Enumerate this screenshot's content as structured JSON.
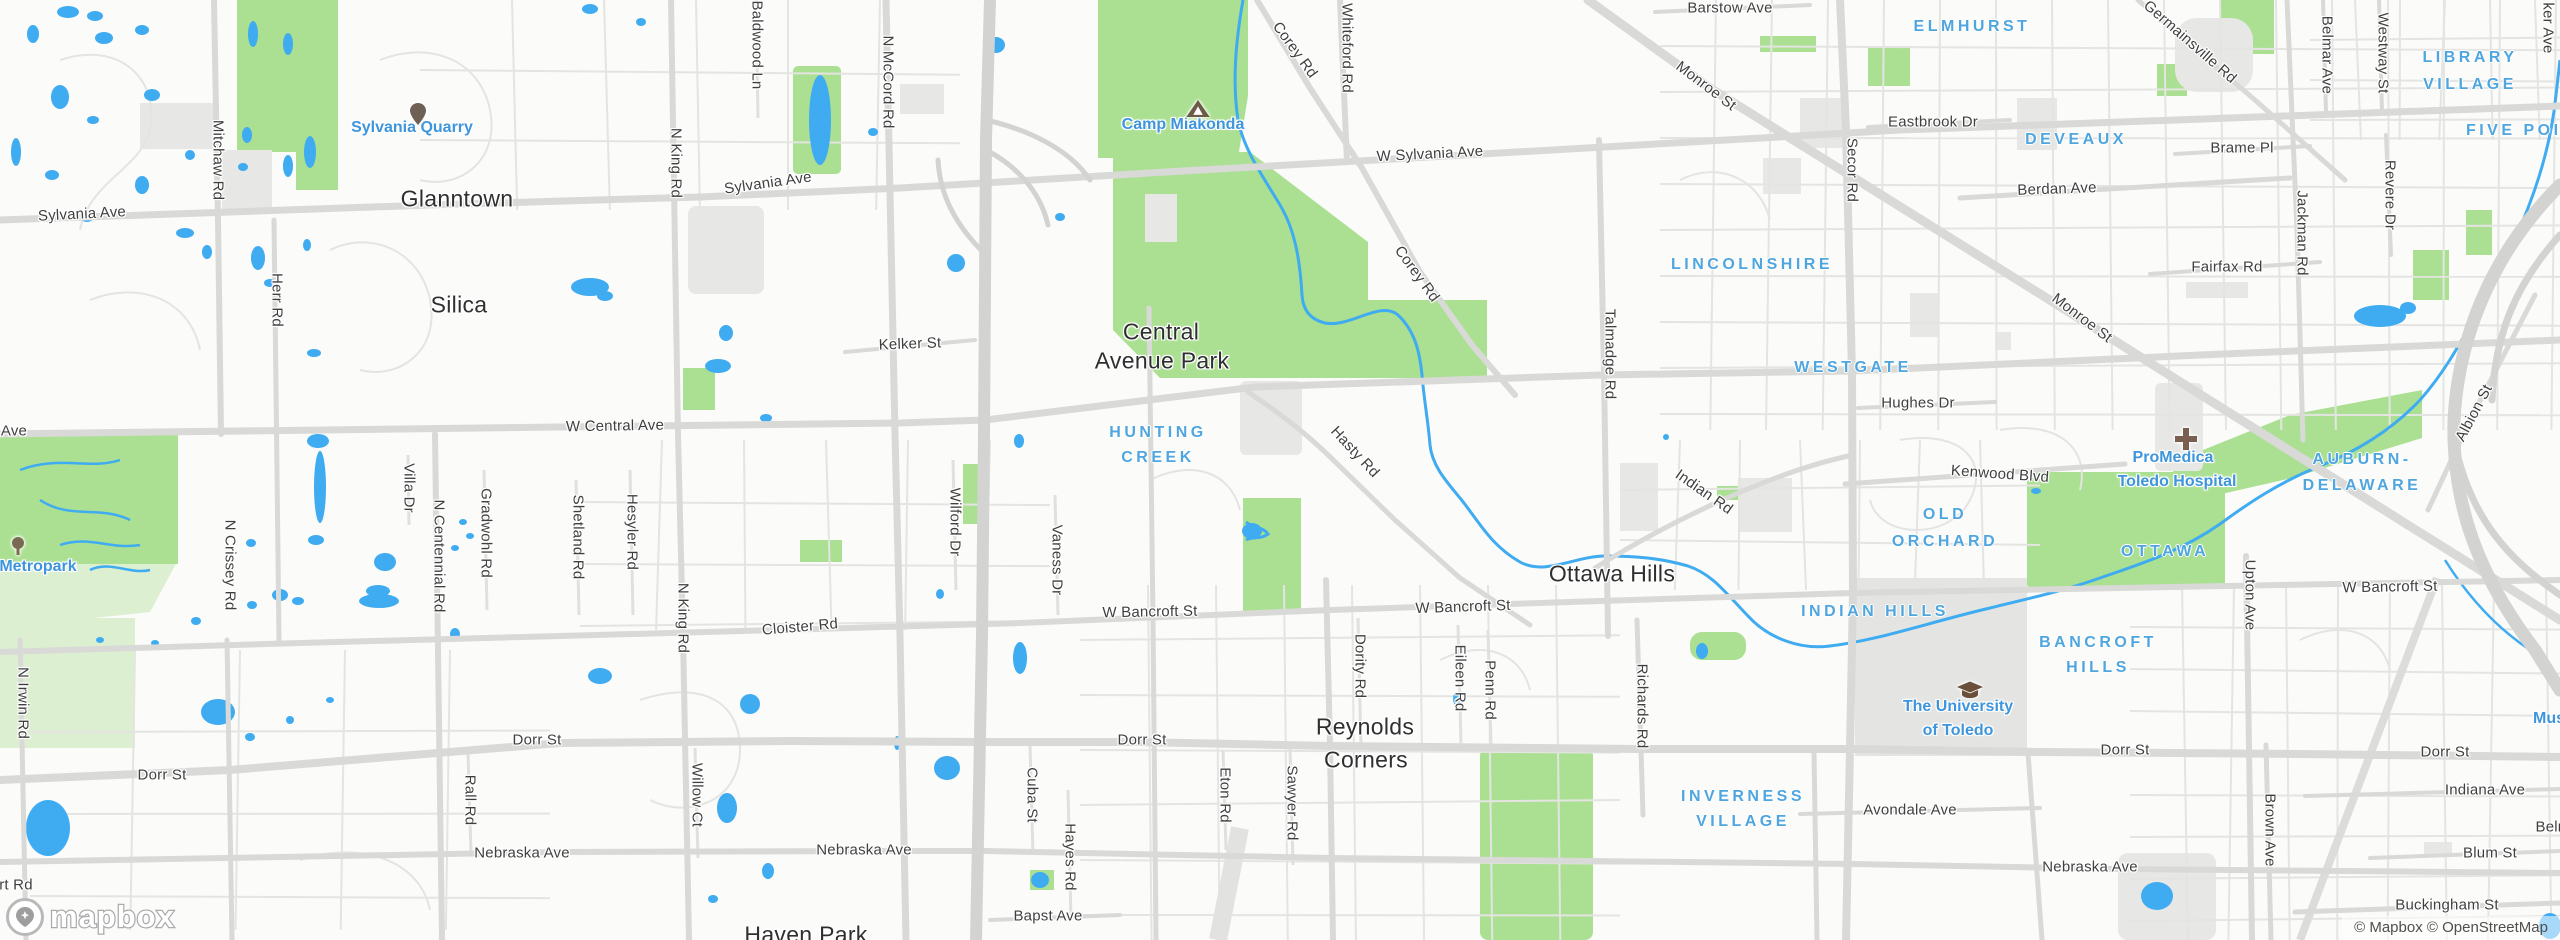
{
  "map": {
    "attribution": "© Mapbox © OpenStreetMap",
    "logo_text": "mapbox",
    "palette": {
      "land": "#FBFBF9",
      "park_green": "#ABE092",
      "pale_green": "#DCEFD0",
      "water_blue": "#3FABF1",
      "urban_gray": "#E7E7E5",
      "road_major": "#D9D9D7",
      "road_minor": "#E4E4E2",
      "highway": "#D3D3D1",
      "label_dark": "#2f2f2f",
      "label_road": "#3f3f3f",
      "label_neighborhood_blue": "#4FA6DF",
      "label_poi_blue": "#3E95DC",
      "icon_brown": "#6e6055"
    },
    "labels": [
      {
        "t": "Sylvania Ave",
        "x": 82,
        "y": 214,
        "r": -3,
        "c": "road"
      },
      {
        "t": "Mitchaw Rd",
        "x": 218,
        "y": 160,
        "r": 90,
        "c": "road"
      },
      {
        "t": "Herr Rd",
        "x": 277,
        "y": 300,
        "r": 90,
        "c": "road"
      },
      {
        "t": "Glanntown",
        "x": 457,
        "y": 199,
        "r": 0,
        "c": "city"
      },
      {
        "t": "Silica",
        "x": 459,
        "y": 305,
        "r": 0,
        "c": "city"
      },
      {
        "t": "Sylvania Quarry",
        "x": 412,
        "y": 128,
        "r": 0,
        "c": "poi"
      },
      {
        "t": "Sylvania Ave",
        "x": 768,
        "y": 183,
        "r": -8,
        "c": "road"
      },
      {
        "t": "N King Rd",
        "x": 676,
        "y": 163,
        "r": 90,
        "c": "road"
      },
      {
        "t": "Baldwood Ln",
        "x": 757,
        "y": 45,
        "r": 90,
        "c": "road"
      },
      {
        "t": "N McCord Rd",
        "x": 888,
        "y": 82,
        "r": 90,
        "c": "road"
      },
      {
        "t": "Kelker St",
        "x": 910,
        "y": 344,
        "r": -2,
        "c": "road"
      },
      {
        "t": "W Central Ave",
        "x": 615,
        "y": 426,
        "r": -1,
        "c": "road"
      },
      {
        "t": "Ave",
        "x": 14,
        "y": 431,
        "r": 0,
        "c": "road"
      },
      {
        "t": "Camp Miakonda",
        "x": 1183,
        "y": 125,
        "r": 0,
        "c": "poi"
      },
      {
        "t": "Corey Rd",
        "x": 1295,
        "y": 50,
        "r": 54,
        "c": "road"
      },
      {
        "t": "Whiteford Rd",
        "x": 1347,
        "y": 48,
        "r": 90,
        "c": "road"
      },
      {
        "t": "W Sylvania Ave",
        "x": 1430,
        "y": 154,
        "r": -3,
        "c": "road"
      },
      {
        "t": "Corey Rd",
        "x": 1417,
        "y": 274,
        "r": 54,
        "c": "road"
      },
      {
        "t": "Monroe St",
        "x": 1706,
        "y": 86,
        "r": 37,
        "c": "road"
      },
      {
        "t": "Barstow Ave",
        "x": 1730,
        "y": 8,
        "r": 0,
        "c": "road"
      },
      {
        "t": "ELMHURST",
        "x": 1972,
        "y": 27,
        "r": 0,
        "c": "nbhd"
      },
      {
        "t": "Eastbrook Dr",
        "x": 1933,
        "y": 122,
        "r": 0,
        "c": "road"
      },
      {
        "t": "DEVEAUX",
        "x": 2076,
        "y": 140,
        "r": 0,
        "c": "nbhd"
      },
      {
        "t": "Berdan Ave",
        "x": 2057,
        "y": 189,
        "r": -2,
        "c": "road"
      },
      {
        "t": "Secor Rd",
        "x": 1852,
        "y": 170,
        "r": 90,
        "c": "road"
      },
      {
        "t": "LINCOLNSHIRE",
        "x": 1752,
        "y": 265,
        "r": 0,
        "c": "nbhd"
      },
      {
        "t": "Monroe St",
        "x": 2082,
        "y": 318,
        "r": 37,
        "c": "road"
      },
      {
        "t": "Germainsville Rd",
        "x": 2190,
        "y": 42,
        "r": 41,
        "c": "road"
      },
      {
        "t": "Belmar Ave",
        "x": 2327,
        "y": 55,
        "r": 90,
        "c": "road"
      },
      {
        "t": "Westway St",
        "x": 2383,
        "y": 53,
        "r": 90,
        "c": "road"
      },
      {
        "t": "ker Ave",
        "x": 2548,
        "y": 28,
        "r": 90,
        "c": "road"
      },
      {
        "t": "LIBRARY",
        "x": 2470,
        "y": 58,
        "r": 0,
        "c": "nbhd"
      },
      {
        "t": "VILLAGE",
        "x": 2470,
        "y": 85,
        "r": 0,
        "c": "nbhd"
      },
      {
        "t": "FIVE POINTS",
        "x": 2535,
        "y": 131,
        "r": 0,
        "c": "nbhd"
      },
      {
        "t": "Brame Pl",
        "x": 2242,
        "y": 148,
        "r": 0,
        "c": "road"
      },
      {
        "t": "Jackman Rd",
        "x": 2302,
        "y": 233,
        "r": 90,
        "c": "road"
      },
      {
        "t": "Revere Dr",
        "x": 2390,
        "y": 195,
        "r": 90,
        "c": "road"
      },
      {
        "t": "Fairfax Rd",
        "x": 2227,
        "y": 267,
        "r": 0,
        "c": "road"
      },
      {
        "t": "Central",
        "x": 1161,
        "y": 332,
        "r": 0,
        "c": "city"
      },
      {
        "t": "Avenue Park",
        "x": 1162,
        "y": 361,
        "r": 0,
        "c": "city"
      },
      {
        "t": "HUNTING",
        "x": 1158,
        "y": 433,
        "r": 0,
        "c": "nbhd"
      },
      {
        "t": "CREEK",
        "x": 1158,
        "y": 458,
        "r": 0,
        "c": "nbhd"
      },
      {
        "t": "Hasty Rd",
        "x": 1355,
        "y": 452,
        "r": 47,
        "c": "road"
      },
      {
        "t": "Talmadge Rd",
        "x": 1610,
        "y": 354,
        "r": 90,
        "c": "road"
      },
      {
        "t": "WESTGATE",
        "x": 1853,
        "y": 368,
        "r": 0,
        "c": "nbhd"
      },
      {
        "t": "Hughes Dr",
        "x": 1918,
        "y": 403,
        "r": 0,
        "c": "road"
      },
      {
        "t": "Kenwood Blvd",
        "x": 2000,
        "y": 474,
        "r": 4,
        "c": "road"
      },
      {
        "t": "Indian Rd",
        "x": 1704,
        "y": 492,
        "r": 35,
        "c": "road"
      },
      {
        "t": "OLD",
        "x": 1945,
        "y": 515,
        "r": 0,
        "c": "nbhd"
      },
      {
        "t": "ORCHARD",
        "x": 1945,
        "y": 542,
        "r": 0,
        "c": "nbhd"
      },
      {
        "t": "ProMedica",
        "x": 2173,
        "y": 458,
        "r": 0,
        "c": "poi"
      },
      {
        "t": "Toledo Hospital",
        "x": 2177,
        "y": 482,
        "r": 0,
        "c": "poi"
      },
      {
        "t": "AUBURN-",
        "x": 2362,
        "y": 460,
        "r": 0,
        "c": "nbhd"
      },
      {
        "t": "DELAWARE",
        "x": 2362,
        "y": 486,
        "r": 0,
        "c": "nbhd"
      },
      {
        "t": "Albion St",
        "x": 2474,
        "y": 413,
        "r": -62,
        "c": "road"
      },
      {
        "t": "OTTAWA",
        "x": 2165,
        "y": 552,
        "r": 0,
        "c": "nbhd"
      },
      {
        "t": "Upton Ave",
        "x": 2250,
        "y": 595,
        "r": 90,
        "c": "road"
      },
      {
        "t": "W Bancroft St",
        "x": 2390,
        "y": 587,
        "r": -1,
        "c": "road"
      },
      {
        "t": "Ottawa Hills",
        "x": 1612,
        "y": 574,
        "r": 0,
        "c": "city"
      },
      {
        "t": "W Bancroft St",
        "x": 1463,
        "y": 607,
        "r": -2,
        "c": "road"
      },
      {
        "t": "W Bancroft St",
        "x": 1150,
        "y": 612,
        "r": -1,
        "c": "road"
      },
      {
        "t": "INDIAN HILLS",
        "x": 1875,
        "y": 612,
        "r": 0,
        "c": "nbhd"
      },
      {
        "t": "BANCROFT",
        "x": 2098,
        "y": 643,
        "r": 0,
        "c": "nbhd"
      },
      {
        "t": "HILLS",
        "x": 2098,
        "y": 668,
        "r": 0,
        "c": "nbhd"
      },
      {
        "t": "The University",
        "x": 1958,
        "y": 707,
        "r": 0,
        "c": "poi"
      },
      {
        "t": "of Toledo",
        "x": 1958,
        "y": 731,
        "r": 0,
        "c": "poi"
      },
      {
        "t": "Mus",
        "x": 2549,
        "y": 719,
        "r": 0,
        "c": "poi"
      },
      {
        "t": "Richards Rd",
        "x": 1642,
        "y": 706,
        "r": 90,
        "c": "road"
      },
      {
        "t": "Dority Rd",
        "x": 1360,
        "y": 666,
        "r": 90,
        "c": "road"
      },
      {
        "t": "Eileen Rd",
        "x": 1460,
        "y": 678,
        "r": 90,
        "c": "road"
      },
      {
        "t": "Penn Rd",
        "x": 1490,
        "y": 690,
        "r": 90,
        "c": "road"
      },
      {
        "t": "Reynolds",
        "x": 1365,
        "y": 727,
        "r": 0,
        "c": "city"
      },
      {
        "t": "Corners",
        "x": 1366,
        "y": 760,
        "r": 0,
        "c": "city"
      },
      {
        "t": "Dorr St",
        "x": 162,
        "y": 775,
        "r": 0,
        "c": "road"
      },
      {
        "t": "Dorr St",
        "x": 537,
        "y": 740,
        "r": 0,
        "c": "road"
      },
      {
        "t": "Dorr St",
        "x": 1142,
        "y": 740,
        "r": 0,
        "c": "road"
      },
      {
        "t": "Dorr St",
        "x": 2125,
        "y": 750,
        "r": 0,
        "c": "road"
      },
      {
        "t": "Dorr St",
        "x": 2445,
        "y": 752,
        "r": 0,
        "c": "road"
      },
      {
        "t": "Villa Dr",
        "x": 409,
        "y": 488,
        "r": 90,
        "c": "road"
      },
      {
        "t": "N Centennial Rd",
        "x": 439,
        "y": 556,
        "r": 90,
        "c": "road"
      },
      {
        "t": "Gradwohl Rd",
        "x": 486,
        "y": 533,
        "r": 90,
        "c": "road"
      },
      {
        "t": "Shetland Rd",
        "x": 578,
        "y": 537,
        "r": 90,
        "c": "road"
      },
      {
        "t": "Hesyler Rd",
        "x": 632,
        "y": 532,
        "r": 90,
        "c": "road"
      },
      {
        "t": "Wilford Dr",
        "x": 955,
        "y": 522,
        "r": 90,
        "c": "road"
      },
      {
        "t": "Vaness Dr",
        "x": 1057,
        "y": 560,
        "r": 90,
        "c": "road"
      },
      {
        "t": "N Crissey Rd",
        "x": 230,
        "y": 565,
        "r": 90,
        "c": "road"
      },
      {
        "t": "N Irwin Rd",
        "x": 23,
        "y": 703,
        "r": 90,
        "c": "road"
      },
      {
        "t": "N King Rd",
        "x": 683,
        "y": 618,
        "r": 90,
        "c": "road"
      },
      {
        "t": "Cloister Rd",
        "x": 800,
        "y": 627,
        "r": -5,
        "c": "road"
      },
      {
        "t": "Metropark",
        "x": 38,
        "y": 567,
        "r": 0,
        "c": "poi"
      },
      {
        "t": "rt Rd",
        "x": 16,
        "y": 885,
        "r": 0,
        "c": "road"
      },
      {
        "t": "Rall Rd",
        "x": 470,
        "y": 800,
        "r": 90,
        "c": "road"
      },
      {
        "t": "Willow Ct",
        "x": 697,
        "y": 795,
        "r": 90,
        "c": "road"
      },
      {
        "t": "Nebraska Ave",
        "x": 522,
        "y": 853,
        "r": 0,
        "c": "road"
      },
      {
        "t": "Nebraska Ave",
        "x": 864,
        "y": 850,
        "r": 0,
        "c": "road"
      },
      {
        "t": "Nebraska Ave",
        "x": 2090,
        "y": 867,
        "r": 0,
        "c": "road"
      },
      {
        "t": "Cuba St",
        "x": 1032,
        "y": 795,
        "r": 90,
        "c": "road"
      },
      {
        "t": "Hayes Rd",
        "x": 1070,
        "y": 857,
        "r": 90,
        "c": "road"
      },
      {
        "t": "Bapst Ave",
        "x": 1048,
        "y": 916,
        "r": 0,
        "c": "road"
      },
      {
        "t": "Haven Park",
        "x": 806,
        "y": 935,
        "r": 0,
        "c": "city"
      },
      {
        "t": "Eton Rd",
        "x": 1225,
        "y": 795,
        "r": 90,
        "c": "road"
      },
      {
        "t": "Sawyer Rd",
        "x": 1292,
        "y": 803,
        "r": 90,
        "c": "road"
      },
      {
        "t": "INVERNESS",
        "x": 1743,
        "y": 797,
        "r": 0,
        "c": "nbhd"
      },
      {
        "t": "VILLAGE",
        "x": 1743,
        "y": 822,
        "r": 0,
        "c": "nbhd"
      },
      {
        "t": "Avondale Ave",
        "x": 1910,
        "y": 810,
        "r": 0,
        "c": "road"
      },
      {
        "t": "Indiana Ave",
        "x": 2485,
        "y": 790,
        "r": 0,
        "c": "road"
      },
      {
        "t": "Brown Ave",
        "x": 2270,
        "y": 830,
        "r": 90,
        "c": "road"
      },
      {
        "t": "Blum St",
        "x": 2490,
        "y": 853,
        "r": 0,
        "c": "road"
      },
      {
        "t": "Buckingham St",
        "x": 2447,
        "y": 905,
        "r": 0,
        "c": "road"
      },
      {
        "t": "Belm",
        "x": 2553,
        "y": 827,
        "r": 0,
        "c": "road"
      }
    ],
    "icons": [
      {
        "type": "pin",
        "x": 410,
        "y": 103,
        "name": "quarry-pin-icon"
      },
      {
        "type": "tent",
        "x": 1186,
        "y": 100,
        "name": "campground-icon"
      },
      {
        "type": "cross",
        "x": 2175,
        "y": 428,
        "name": "hospital-icon"
      },
      {
        "type": "cap",
        "x": 1957,
        "y": 681,
        "name": "university-icon"
      },
      {
        "type": "tree",
        "x": 10,
        "y": 537,
        "name": "tree-icon"
      }
    ]
  }
}
